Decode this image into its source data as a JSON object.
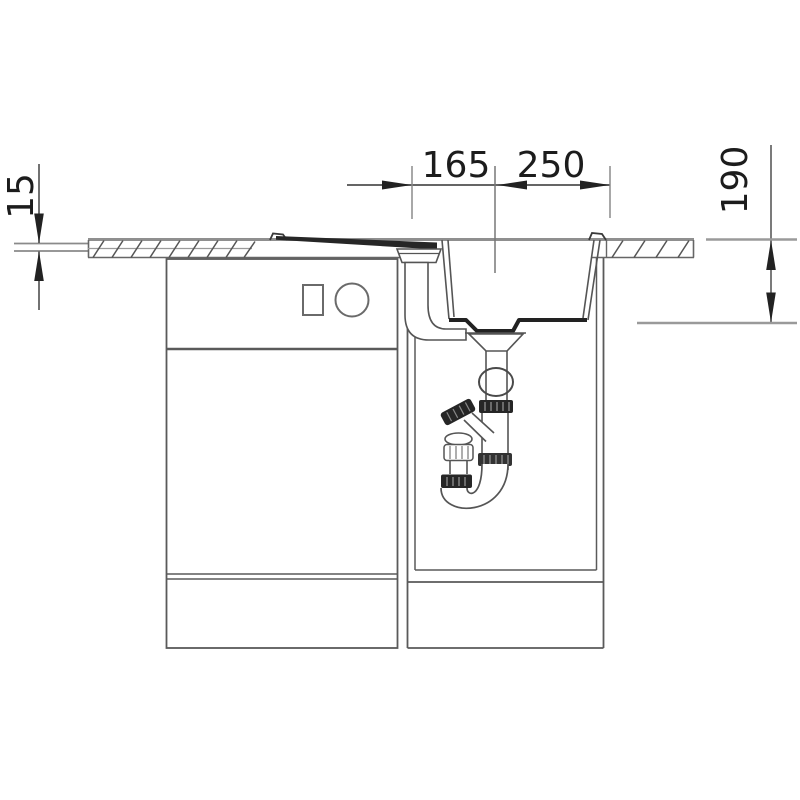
{
  "drawing": {
    "type": "sink-installation-section-view",
    "dimensions": {
      "top_left_mm": "165",
      "top_right_mm": "250",
      "right_mm": "190",
      "left_mm": "15"
    },
    "colors": {
      "background": "#ffffff",
      "line": "#555555",
      "light_line": "#999999",
      "heavy": "#222222",
      "text": "#1c1c1c"
    }
  }
}
